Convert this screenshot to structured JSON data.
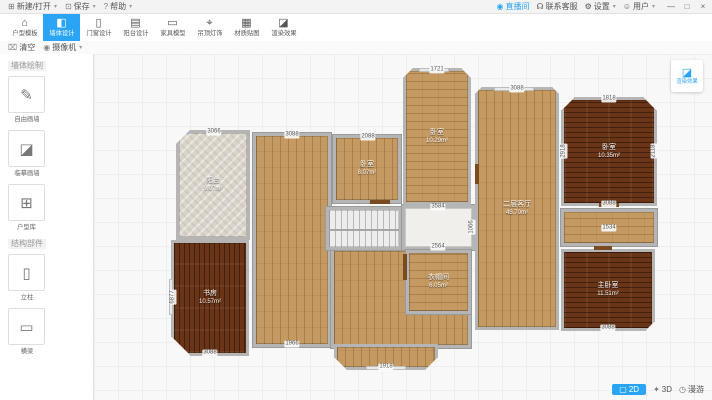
{
  "window": {
    "menus": [
      {
        "name": "new-open",
        "icon": "⊞",
        "label": "新建/打开"
      },
      {
        "name": "save",
        "icon": "⊡",
        "label": "保存"
      },
      {
        "name": "help",
        "icon": "?",
        "label": "帮助"
      }
    ],
    "live": "直播间",
    "support": "联系客服",
    "settings": "设置",
    "user": "用户",
    "minimize": "—",
    "maximize": "□",
    "close": "×"
  },
  "toolbar": {
    "tools": [
      {
        "name": "floorplan-template",
        "label": "户型模板",
        "icon": "⌂",
        "active": false
      },
      {
        "name": "wall-design",
        "label": "墙体设计",
        "icon": "◧",
        "active": true
      },
      {
        "name": "door-window-design",
        "label": "门窗设计",
        "icon": "▯",
        "active": false
      },
      {
        "name": "balcony-design",
        "label": "阳台设计",
        "icon": "▤",
        "active": false
      },
      {
        "name": "furniture-models",
        "label": "家具模型",
        "icon": "▭",
        "active": false
      },
      {
        "name": "ceiling-lighting",
        "label": "吊顶灯饰",
        "icon": "⌖",
        "active": false
      },
      {
        "name": "material-textures",
        "label": "材质贴图",
        "icon": "▦",
        "active": false
      },
      {
        "name": "render-effects",
        "label": "渲染效果",
        "icon": "◪",
        "active": false
      }
    ]
  },
  "actionbar": {
    "clear": "清空",
    "camera": "摄像机"
  },
  "sidebar": {
    "sections": [
      {
        "title": "墙体绘制",
        "items": [
          {
            "name": "free-draw-wall",
            "label": "自由画墙",
            "icon": "✎"
          },
          {
            "name": "trace-draw-wall",
            "label": "临摹画墙",
            "icon": "◪"
          },
          {
            "name": "floorplan-library",
            "label": "户型库",
            "icon": "⊞"
          }
        ]
      },
      {
        "title": "结构部件",
        "items": [
          {
            "name": "column",
            "label": "立柱",
            "icon": "▯"
          },
          {
            "name": "beam",
            "label": "横梁",
            "icon": "▭"
          }
        ]
      }
    ]
  },
  "canvas": {
    "render_button": "渲染效果",
    "view2d": "2D",
    "view3d": "3D",
    "roam": "漫游",
    "accent": "#2aa5f5"
  },
  "floorplan": {
    "rooms": [
      {
        "name": "hall-left",
        "x": 159,
        "y": 79,
        "w": 78,
        "h": 214,
        "floor": "woodv"
      },
      {
        "name": "hall-bottom",
        "x": 237,
        "y": 194,
        "w": 140,
        "h": 100,
        "floor": "woodv"
      },
      {
        "name": "bay-window",
        "x": 240,
        "y": 290,
        "w": 104,
        "h": 26,
        "floor": "woodv",
        "clip": "blr13"
      },
      {
        "name": "stairs",
        "x": 232,
        "y": 153,
        "w": 76,
        "h": 43,
        "floor": "stair"
      },
      {
        "name": "corridor",
        "x": 308,
        "y": 151,
        "w": 73,
        "h": 45,
        "floor": "plain"
      },
      {
        "name": "balcony",
        "label": "阳台",
        "area": "9.07m²",
        "x": 82,
        "y": 76,
        "w": 74,
        "h": 110,
        "floor": "stone",
        "clip": "tl14"
      },
      {
        "name": "study",
        "label": "书房",
        "area": "10.57m²",
        "x": 77,
        "y": 186,
        "w": 78,
        "h": 116,
        "floor": "darkv",
        "clip": "bl20"
      },
      {
        "name": "bedroom-2",
        "label": "卧室",
        "area": "8.07m²",
        "x": 239,
        "y": 81,
        "w": 68,
        "h": 68,
        "floor": "woodv"
      },
      {
        "name": "bedroom-3",
        "label": "卧室",
        "area": "10.29m²",
        "x": 309,
        "y": 14,
        "w": 68,
        "h": 137,
        "floor": "woodh",
        "clip": "tlr10"
      },
      {
        "name": "living-room",
        "label": "二层客厅",
        "area": "45.70m²",
        "x": 381,
        "y": 33,
        "w": 84,
        "h": 243,
        "floor": "woodv",
        "clip": "tlr7"
      },
      {
        "name": "bedroom-1",
        "label": "卧室",
        "area": "10.35m²",
        "x": 467,
        "y": 43,
        "w": 96,
        "h": 109,
        "floor": "darkh",
        "clip": "tlr14"
      },
      {
        "name": "storage",
        "x": 467,
        "y": 155,
        "w": 96,
        "h": 37,
        "floor": "woodh"
      },
      {
        "name": "master-bedroom",
        "label": "主卧室",
        "area": "11.51m²",
        "x": 467,
        "y": 195,
        "w": 94,
        "h": 82,
        "floor": "darkh",
        "clip": "br10"
      },
      {
        "name": "closet",
        "label": "衣帽间",
        "area": "6.05m²",
        "x": 312,
        "y": 196,
        "w": 65,
        "h": 64,
        "floor": "woodh"
      }
    ],
    "dims": [
      {
        "t": "3066",
        "x": 120,
        "y": 78
      },
      {
        "t": "3088",
        "x": 198,
        "y": 81
      },
      {
        "t": "2088",
        "x": 274,
        "y": 83
      },
      {
        "t": "1721",
        "x": 343,
        "y": 16
      },
      {
        "t": "3088",
        "x": 423,
        "y": 35
      },
      {
        "t": "1818",
        "x": 515,
        "y": 45
      },
      {
        "t": "2918",
        "x": 470,
        "y": 97,
        "v": true
      },
      {
        "t": "2118",
        "x": 560,
        "y": 97,
        "v": true
      },
      {
        "t": "3088",
        "x": 515,
        "y": 150
      },
      {
        "t": "1534",
        "x": 515,
        "y": 174
      },
      {
        "t": "3088",
        "x": 514,
        "y": 274
      },
      {
        "t": "6877",
        "x": 79,
        "y": 243,
        "v": true
      },
      {
        "t": "3088",
        "x": 116,
        "y": 299
      },
      {
        "t": "1918",
        "x": 292,
        "y": 313
      },
      {
        "t": "3584",
        "x": 344,
        "y": 153
      },
      {
        "t": "2564",
        "x": 344,
        "y": 193
      },
      {
        "t": "1066",
        "x": 378,
        "y": 173,
        "v": true
      },
      {
        "t": "1966",
        "x": 198,
        "y": 290
      }
    ],
    "doors": [
      {
        "x": 309,
        "y": 200,
        "w": 4,
        "h": 26
      },
      {
        "x": 276,
        "y": 146,
        "w": 20,
        "h": 4
      },
      {
        "x": 381,
        "y": 110,
        "w": 4,
        "h": 20
      },
      {
        "x": 505,
        "y": 149,
        "w": 20,
        "h": 4
      },
      {
        "x": 500,
        "y": 192,
        "w": 18,
        "h": 4
      }
    ],
    "windows": [
      {
        "x": 325,
        "y": 14,
        "w": 30,
        "h": 4
      },
      {
        "x": 272,
        "y": 312,
        "w": 40,
        "h": 4
      },
      {
        "x": 75,
        "y": 225,
        "w": 4,
        "h": 36
      },
      {
        "x": 400,
        "y": 33,
        "w": 40,
        "h": 4
      }
    ]
  }
}
